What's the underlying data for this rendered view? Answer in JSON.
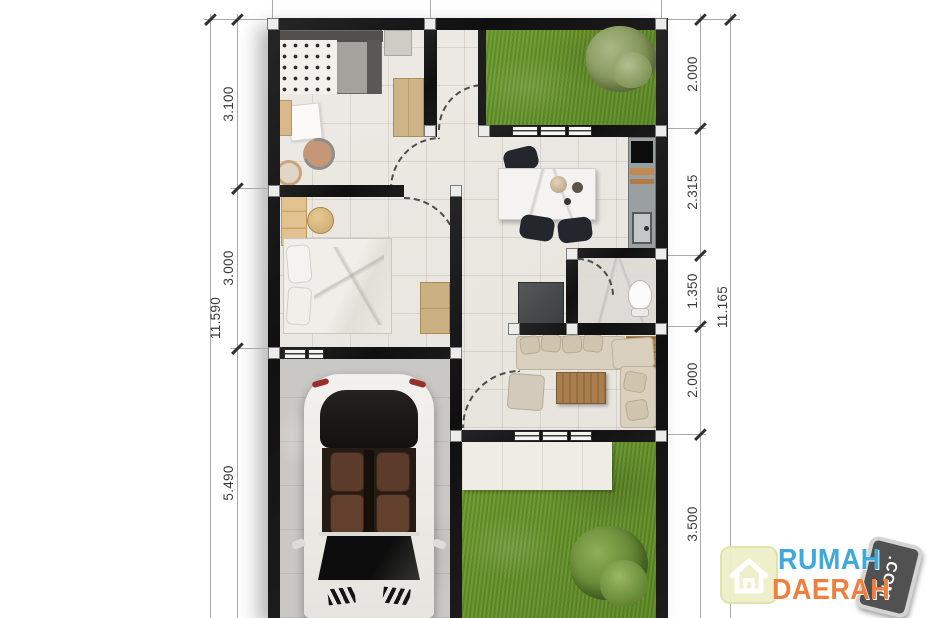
{
  "plan": {
    "dimensions_left": {
      "segments": [
        "3.100",
        "3.000",
        "5.490"
      ],
      "total": "11.590"
    },
    "dimensions_right": {
      "segments": [
        "2.000",
        "2.315",
        "1.350",
        "2.000",
        "3.500"
      ],
      "total": "11.165"
    }
  },
  "watermark": {
    "word1": "RUMAH",
    "word2": "DAERAH",
    "tld": ".COM"
  },
  "colors": {
    "wall": "#171717",
    "floor_tile": "#e9e6e1",
    "garage_floor": "#c9c8c5",
    "grass": "#669328",
    "marble": "#f4f3f1",
    "wood": "#a87e4c",
    "logo_blue": "#3fa9dc",
    "logo_orange": "#ef7f3e",
    "dimension_text": "#3b3b3b"
  }
}
